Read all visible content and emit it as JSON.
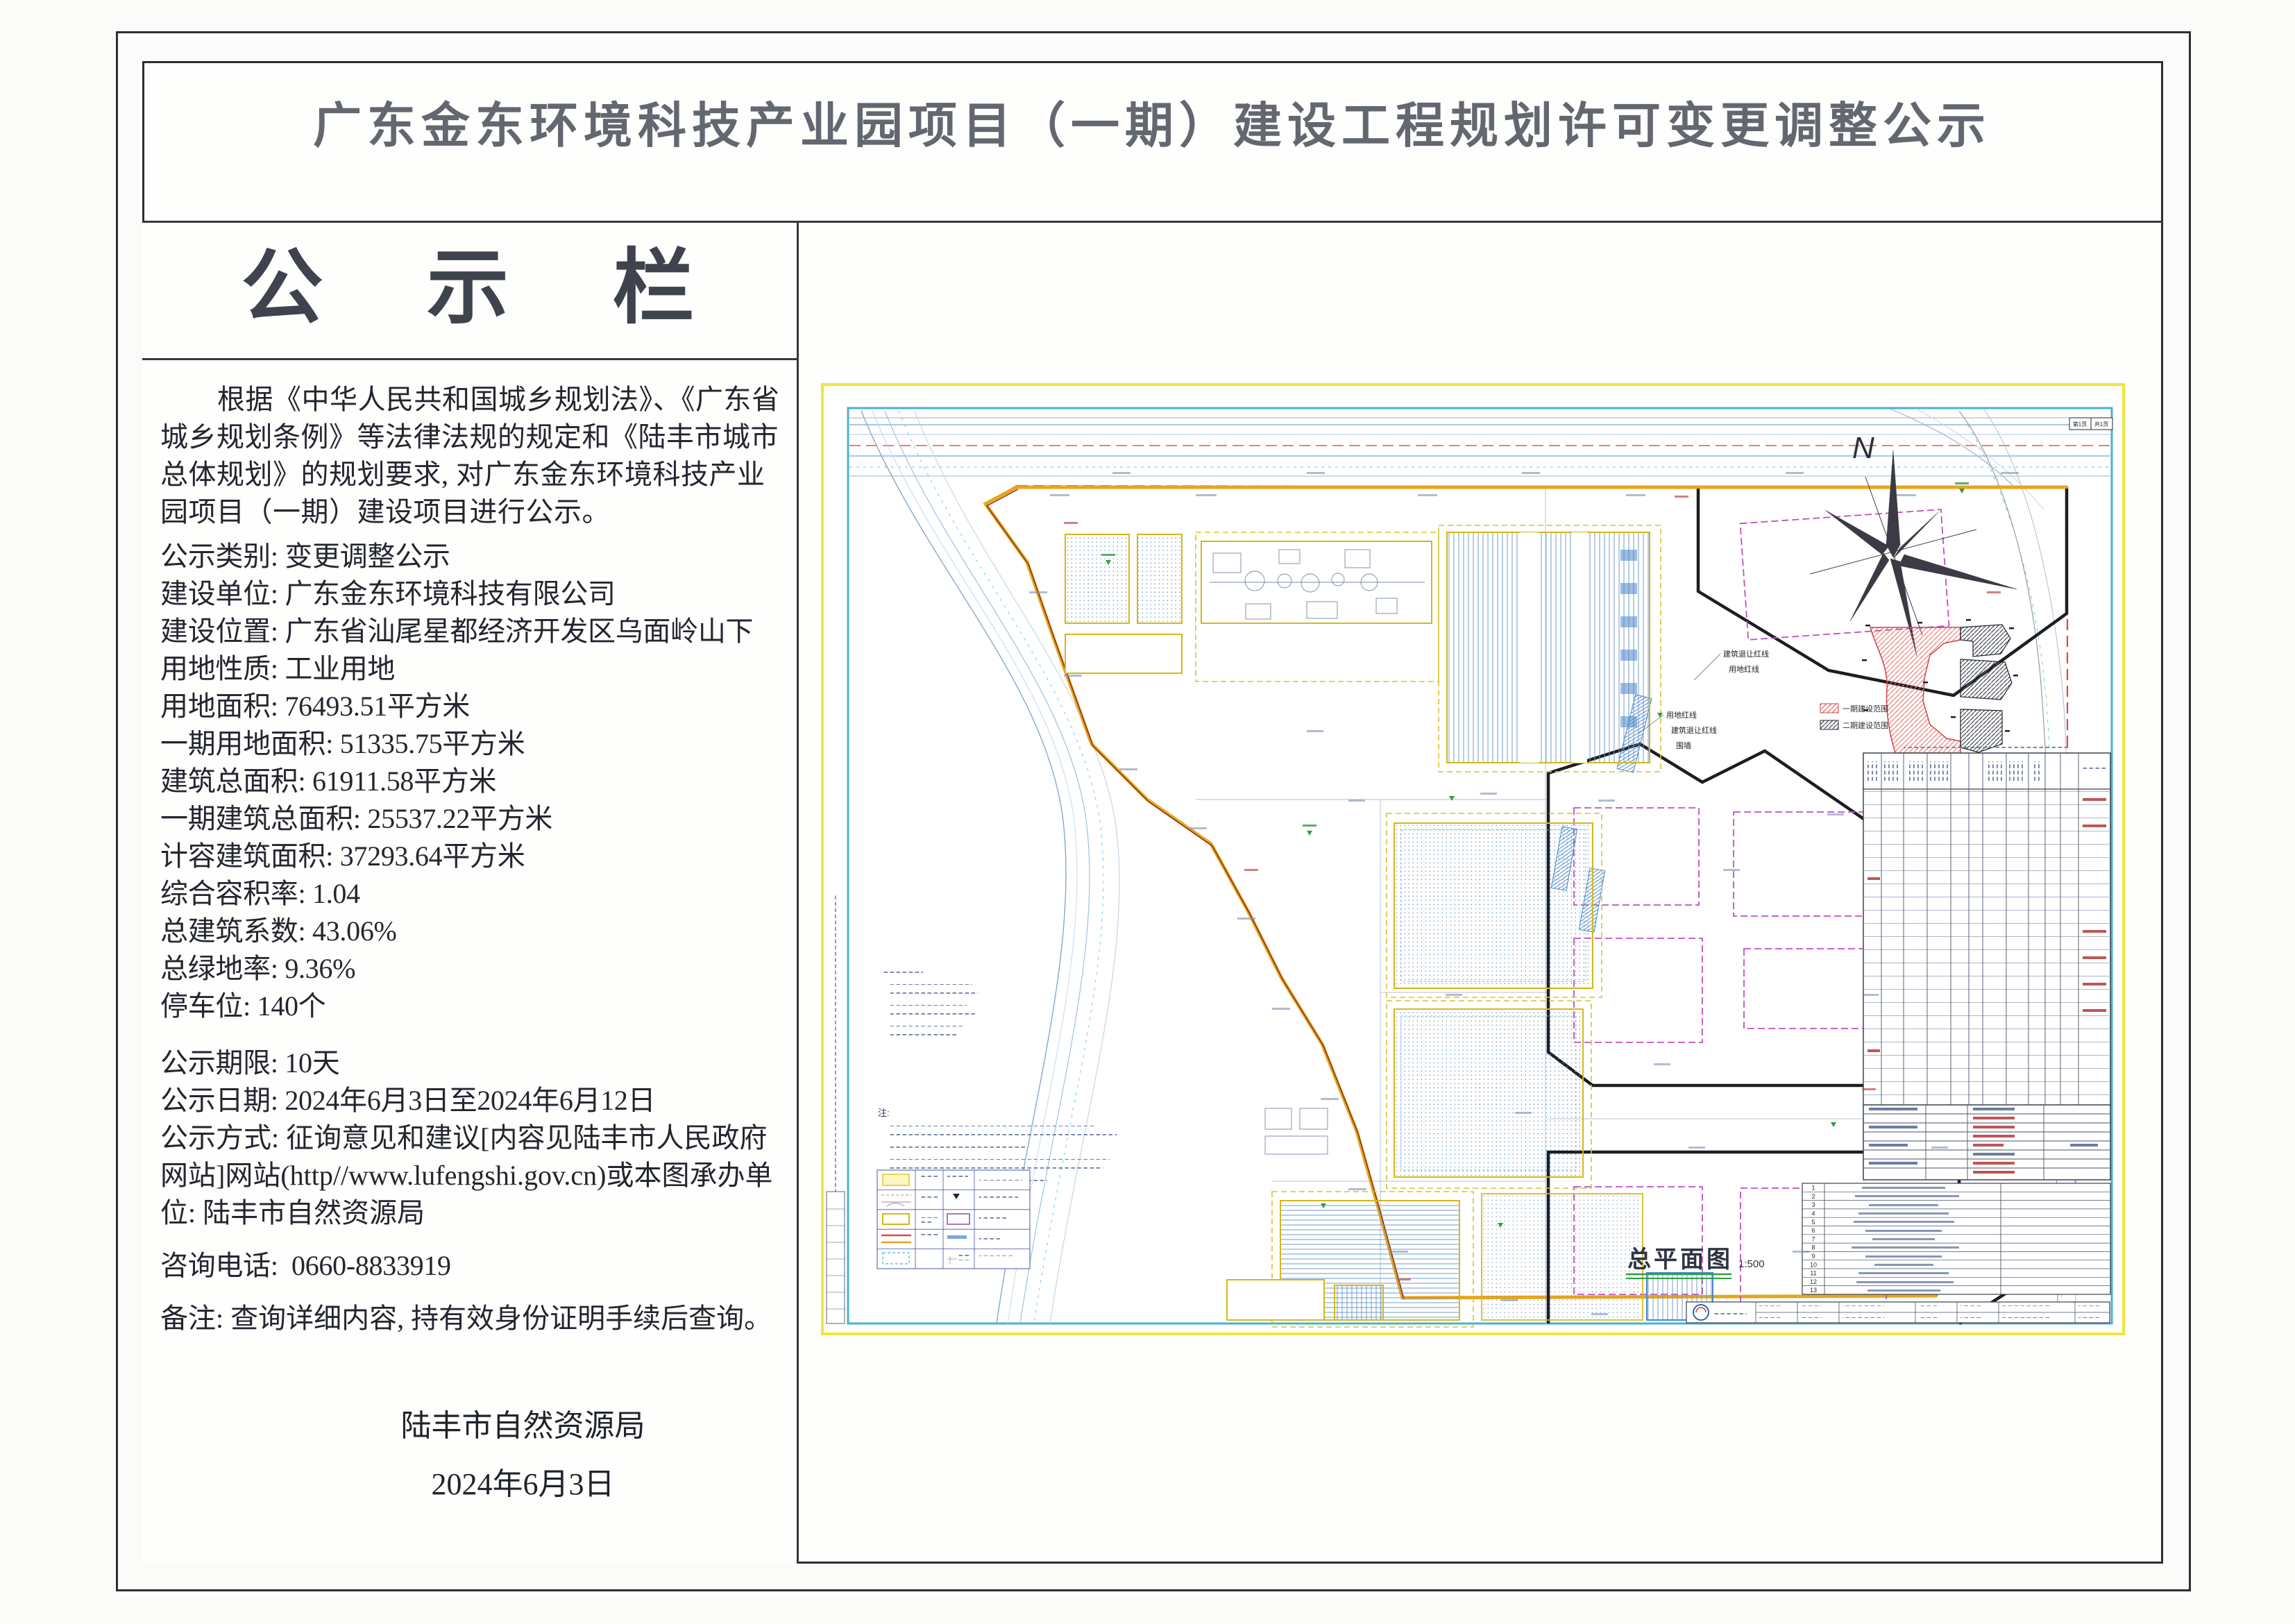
{
  "page": {
    "title": "广东金东环境科技产业园项目（一期）建设工程规划许可变更调整公示"
  },
  "notice": {
    "header": "公 示 栏",
    "sep": ": ",
    "intro": "根据《中华人民共和国城乡规划法》、《广东省城乡规划条例》等法律法规的规定和《陆丰市城市总体规划》的规划要求, 对广东金东环境科技产业园项目（一期）建设项目进行公示。",
    "fields": [
      {
        "label": "公示类别",
        "value": "变更调整公示"
      },
      {
        "label": "建设单位",
        "value": "广东金东环境科技有限公司"
      },
      {
        "label": "建设位置",
        "value": "广东省汕尾星都经济开发区乌面岭山下"
      },
      {
        "label": "用地性质",
        "value": "工业用地"
      },
      {
        "label": "用地面积",
        "value": "76493.51平方米"
      },
      {
        "label": "一期用地面积",
        "value": "51335.75平方米"
      },
      {
        "label": "建筑总面积",
        "value": "61911.58平方米"
      },
      {
        "label": "一期建筑总面积",
        "value": "25537.22平方米"
      },
      {
        "label": "计容建筑面积",
        "value": "37293.64平方米"
      },
      {
        "label": "综合容积率",
        "value": "1.04"
      },
      {
        "label": "总建筑系数",
        "value": "43.06%"
      },
      {
        "label": "总绿地率",
        "value": "9.36%"
      },
      {
        "label": "停车位",
        "value": "140个"
      }
    ],
    "publicity": [
      {
        "label": "公示期限",
        "value": "10天"
      },
      {
        "label": "公示日期",
        "value": "2024年6月3日至2024年6月12日"
      }
    ],
    "method_label": "公示方式",
    "method_value": "征询意见和建议[内容见陆丰市人民政府网站]网站(http//www.lufengshi.gov.cn)或本图承办单位: 陆丰市自然资源局",
    "phone_label": "咨询电话",
    "phone_value": "0660-8833919",
    "remark_label": "备注",
    "remark_value": "查询详细内容, 持有效身份证明手续后查询。",
    "signature_org": "陆丰市自然资源局",
    "signature_date": "2024年6月3日"
  },
  "drawing": {
    "plan_title": "总平面图",
    "plan_scale": "1:500",
    "compass_label": "N",
    "page_box_left": "第1页",
    "page_box_right": "共1页",
    "inset_legend": [
      {
        "label": "一期建设范围",
        "color": "#e26b63"
      },
      {
        "label": "二期建设范围",
        "color": "#555a63"
      }
    ],
    "boundary_labels": {
      "setback": "建筑退让红线",
      "redline": "用地红线",
      "wall": "围墙"
    },
    "notes_title": "注:",
    "row_numbers": [
      "1",
      "2",
      "3",
      "4",
      "5",
      "6",
      "7",
      "8",
      "9",
      "10",
      "11",
      "12",
      "13"
    ]
  },
  "colors": {
    "frame_yellow": "#f0e53e",
    "frame_cyan": "#44b3d5",
    "boundary_red": "#e04848",
    "boundary_orange": "#e8a41c",
    "phase2_black": "#1d1d24",
    "phase2_magenta": "#c050c0",
    "building_blue": "#6f9cc8",
    "green_mark": "#2f9e44"
  }
}
